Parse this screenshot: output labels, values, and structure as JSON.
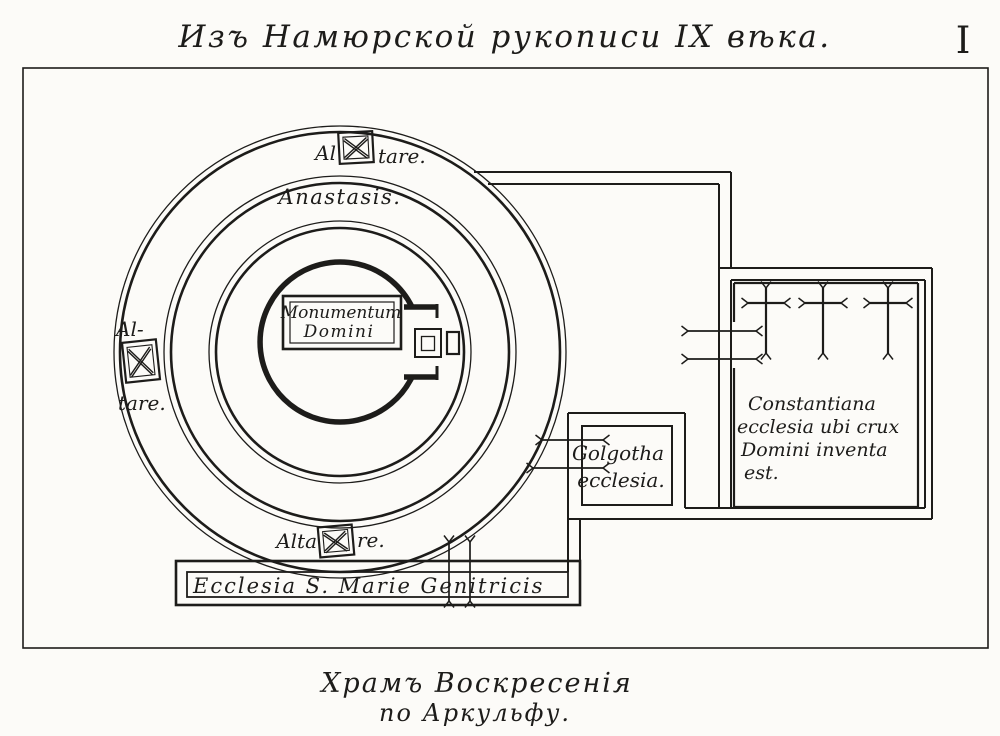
{
  "header": {
    "title": "Изъ Намюрской рукописи IX вѣка.",
    "plate_numeral": "I"
  },
  "caption": {
    "line1": "Храмъ Воскресенія",
    "line2": "по Аркульфу."
  },
  "plan": {
    "anastasis_label": "Anastasis.",
    "monumentum": {
      "line1": "Monumentum",
      "line2": "Domini"
    },
    "altar_top": {
      "before": "Al",
      "after": "tare."
    },
    "altar_left": {
      "before": "Al-",
      "after": "tare."
    },
    "altar_bottom": {
      "before": "Alta",
      "after": "re."
    },
    "golgotha": {
      "line1": "Golgotha",
      "line2": "ecclesia."
    },
    "constantiana": {
      "line1": "Constantiana",
      "line2": "ecclesia ubi crux",
      "line3": "Domini inventa",
      "line4": "est."
    },
    "st_marie_label": "Ecclesia S. Marie Genitricis"
  },
  "icons": {
    "altar_marker": "crossed-square-altar-icon",
    "cross": "forked-latin-cross-icon"
  },
  "colors": {
    "ink": "#1d1c1a",
    "paper": "#fcfbf8"
  }
}
